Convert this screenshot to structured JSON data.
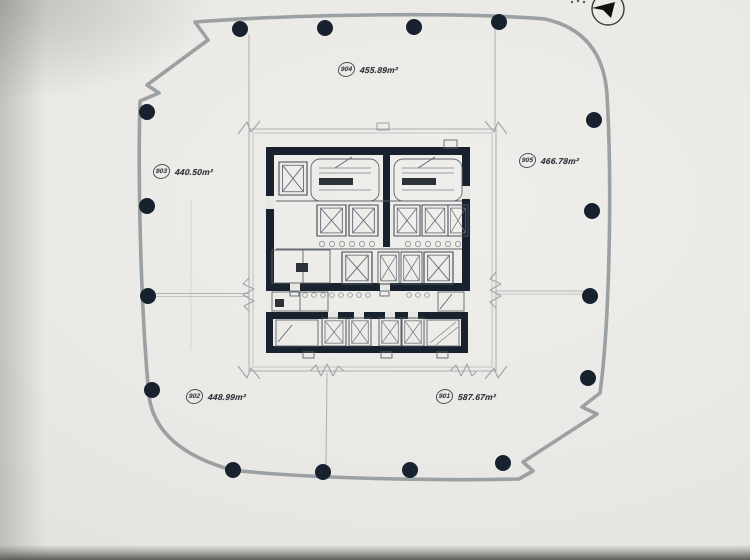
{
  "compass": {
    "icon": "north-arrow-icon"
  },
  "units": [
    {
      "number": "904",
      "area": "455.89m²"
    },
    {
      "number": "903",
      "area": "440.50m²"
    },
    {
      "number": "905",
      "area": "466.78m²"
    },
    {
      "number": "902",
      "area": "448.99m²"
    },
    {
      "number": "901",
      "area": "587.67m²"
    }
  ],
  "colors": {
    "paper": "#e9e7e3",
    "wall_dark": "#18222e",
    "line_gray": "#9ba0a3",
    "label_text": "#30343c"
  }
}
